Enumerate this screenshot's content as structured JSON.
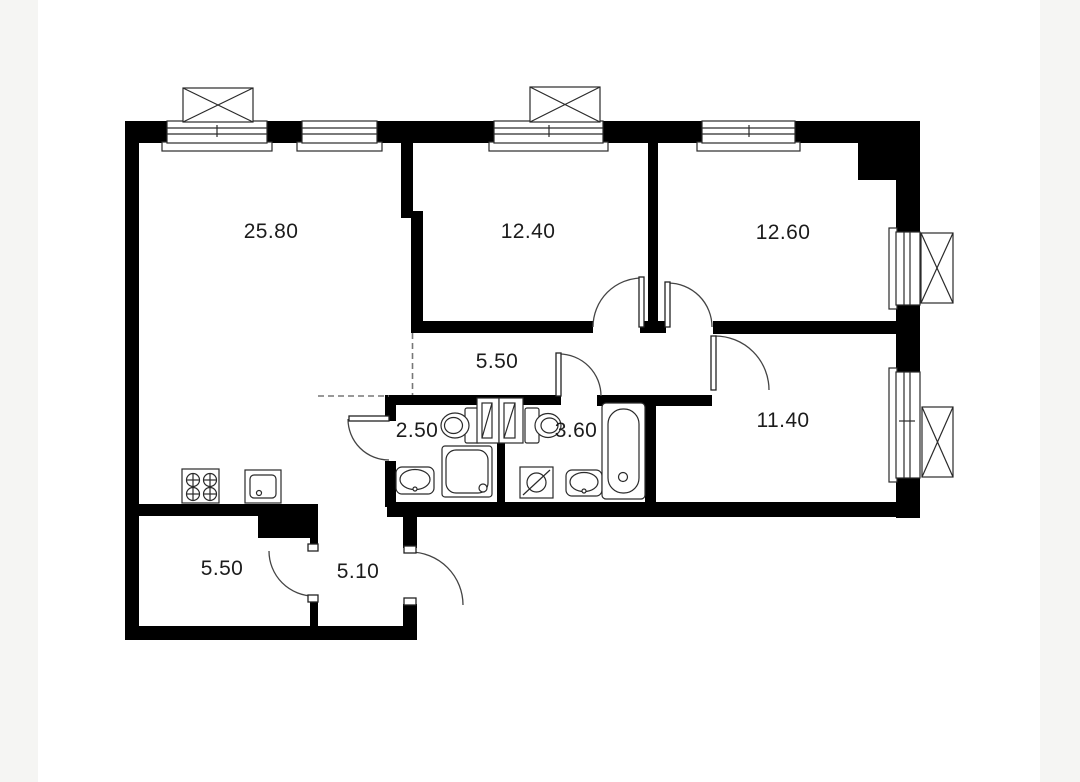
{
  "plan_title": "apartment-floor-plan",
  "palette": {
    "background": "#f5f5f3",
    "card": "#ffffff",
    "wall": "#000000",
    "line": "#333333",
    "dashed_line": "#777777",
    "text": "#1c1c1c"
  },
  "rooms": [
    {
      "id": "living-kitchen",
      "area": "25.80"
    },
    {
      "id": "bedroom-1",
      "area": "12.40"
    },
    {
      "id": "bedroom-2",
      "area": "12.60"
    },
    {
      "id": "corridor",
      "area": "5.50"
    },
    {
      "id": "wc",
      "area": "2.50"
    },
    {
      "id": "bathroom",
      "area": "3.60"
    },
    {
      "id": "bedroom-3",
      "area": "11.40"
    },
    {
      "id": "storage-room",
      "area": "5.50"
    },
    {
      "id": "hallway",
      "area": "5.10"
    }
  ],
  "icons": [
    "window-icon",
    "ac-unit-icon",
    "door-swing-icon",
    "stove-icon",
    "kitchen-sink-icon",
    "toilet-icon",
    "shower-icon",
    "washbasin-icon",
    "washing-machine-icon",
    "bathtub-icon",
    "vent-shaft-icon"
  ]
}
